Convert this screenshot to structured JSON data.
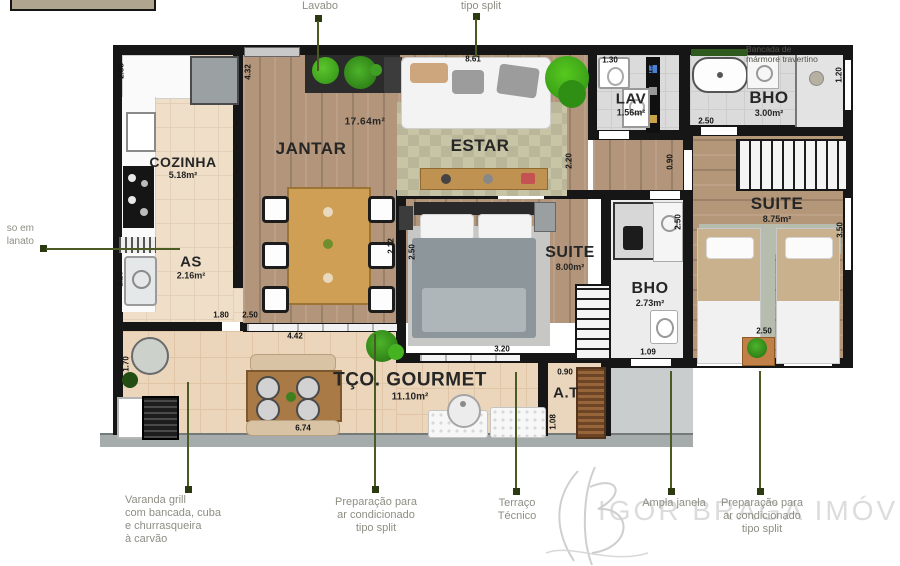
{
  "rooms": {
    "cozinha": {
      "name": "COZINHA",
      "area": "5.18m²"
    },
    "as": {
      "name": "AS",
      "area": "2.16m²"
    },
    "jantar": {
      "name": "JANTAR",
      "area": "17.64m²"
    },
    "estar": {
      "name": "ESTAR"
    },
    "lav": {
      "name": "LAV",
      "area": "1.56m²"
    },
    "bho1": {
      "name": "BHO",
      "area": "3.00m²"
    },
    "suite2": {
      "name": "SUITE",
      "area": "8.75m²"
    },
    "suite1": {
      "name": "SUITE",
      "area": "8.00m²"
    },
    "bho2": {
      "name": "BHO",
      "area": "2.73m²"
    },
    "gourmet": {
      "name": "TÇO. GOURMET",
      "area": "11.10m²"
    },
    "at": {
      "name": "A.T"
    }
  },
  "dims": {
    "cozinha_left": "2.88",
    "jantar_left": "4.32",
    "estar_top": "8.61",
    "lav_top": "1.30",
    "lav_right": "1.20",
    "bho1_bottom": "2.50",
    "bho1_right": "1.20",
    "hall_width": "0.90",
    "hall_height": "2.20",
    "jantar_right": "2.12",
    "suite1_left": "2.50",
    "suite1_bottom": "3.20",
    "bho2_right": "2.50",
    "bho2_bottom": "1.09",
    "suite2_right": "3.50",
    "suite2_bottom": "2.50",
    "as_left": "1.20",
    "as_bottom": "1.80",
    "jantar_bottom": "2.50",
    "terrace_top": "4.42",
    "service_left": "1.70",
    "terrace_bottom": "6.74",
    "at_top": "0.90",
    "at_left": "1.08"
  },
  "callouts": {
    "lavabo": "Lavabo",
    "tipo_split_top": "tipo split",
    "piso_fragment": "so em\nlanato",
    "bancada": "Bancada de\nmármore travertino",
    "varanda": "Varanda grill\ncom bancada, cuba\ne churrasqueira\nà carvão",
    "prep_ac_left": "Preparação para\nar condicionado\ntipo split",
    "terraco_tecnico": "Terraço\nTécnico",
    "ampla_janela": "Ampla janela",
    "prep_ac_right": "Preparação para\nar condicionado\ntipo split"
  },
  "watermark": {
    "brand": "IGOR BRAGA IMÓVEIS"
  }
}
